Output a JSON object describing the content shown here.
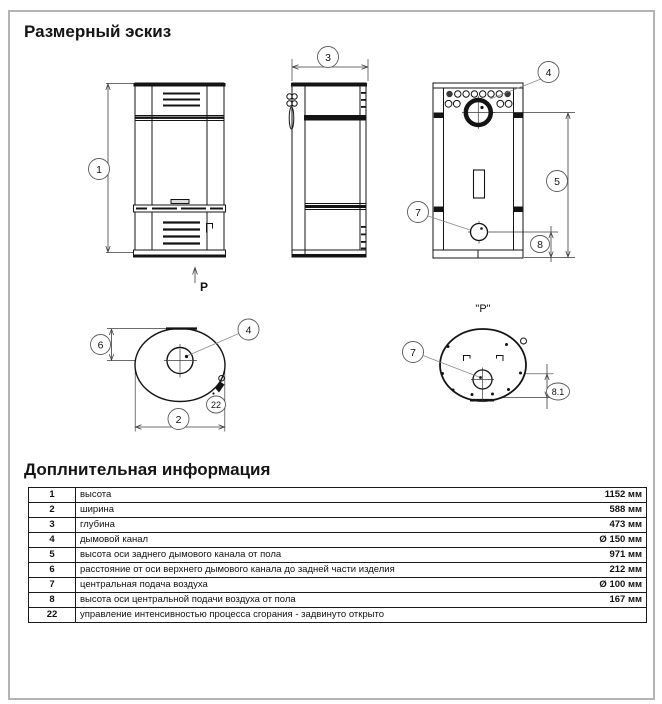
{
  "page": {
    "title": "Размерный эскиз",
    "info_title": "Доплнительная информация"
  },
  "labels": {
    "view_arrow": "P",
    "view_name": "\"P\""
  },
  "callouts": {
    "height": "1",
    "width": "2",
    "depth": "3",
    "flue": "4",
    "flue_axis": "5",
    "flue_offset": "6",
    "air": "7",
    "air_axis": "8",
    "air_axis_detail": "8.1",
    "control": "22"
  },
  "table": {
    "rows": [
      {
        "num": "1",
        "desc": "высота",
        "value": "1152 мм"
      },
      {
        "num": "2",
        "desc": "ширина",
        "value": "588 мм"
      },
      {
        "num": "3",
        "desc": "глубина",
        "value": "473 мм"
      },
      {
        "num": "4",
        "desc": "дымовой канал",
        "value": "Ø 150 мм"
      },
      {
        "num": "5",
        "desc": "высота оси заднего дымового канала от пола",
        "value": "971 мм"
      },
      {
        "num": "6",
        "desc": "расстояние от оси верхнего дымового канала до задней части изделия",
        "value": "212 мм"
      },
      {
        "num": "7",
        "desc": "центральная подача воздуха",
        "value": "Ø 100 мм"
      },
      {
        "num": "8",
        "desc": "высота оси центральной подачи воздуха от пола",
        "value": "167 мм"
      },
      {
        "num": "22",
        "desc": "управление интенсивностью процесса сгорания - задвинуто открыто",
        "value": ""
      }
    ]
  }
}
